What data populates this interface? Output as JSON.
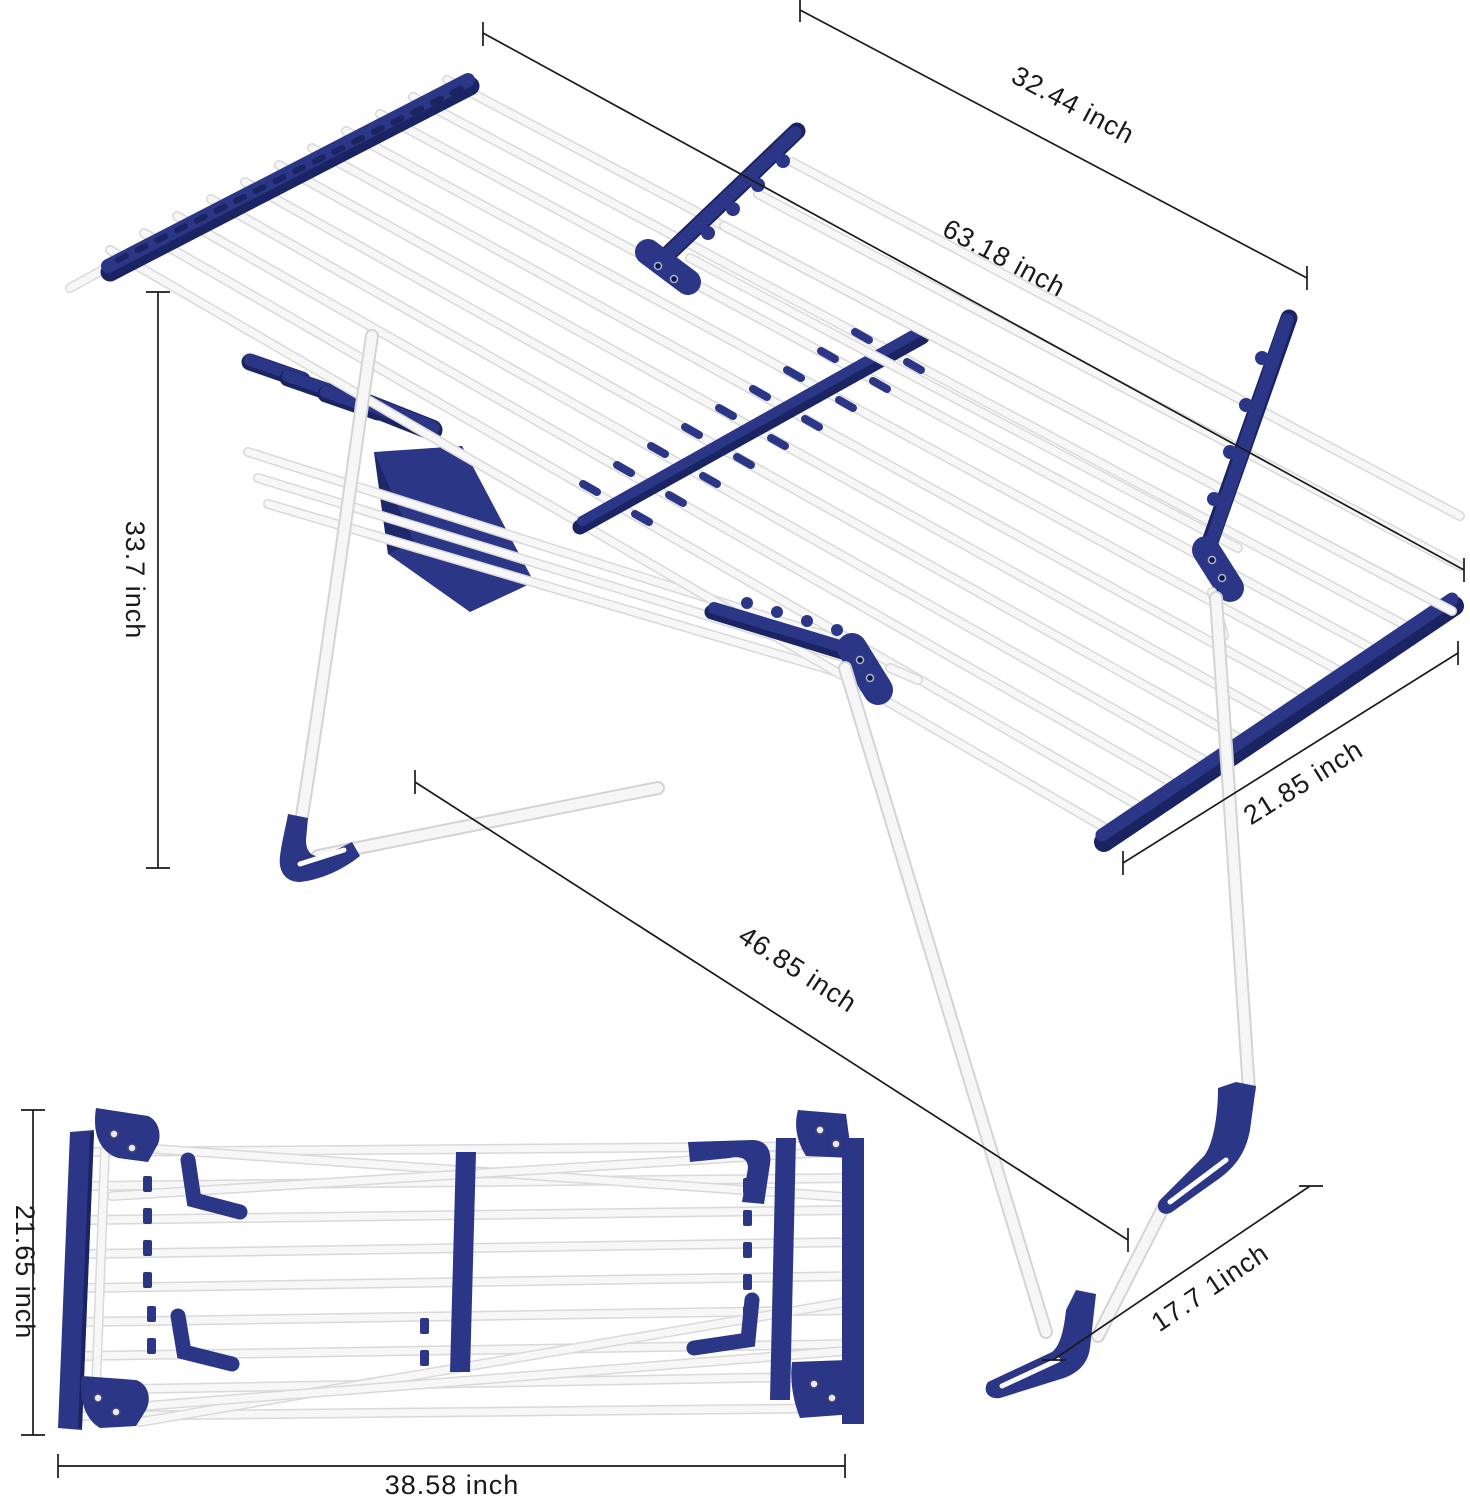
{
  "unit": "inch",
  "colors": {
    "navy": "#2b3687",
    "navy_dark": "#1b2462",
    "rod_white": "#f7f7f7",
    "rod_edge": "#d9d9d9",
    "dimension_line": "#1a1a1a",
    "background": "#ffffff"
  },
  "dimensions": [
    {
      "id": "wing-width",
      "label": "32.44 inch"
    },
    {
      "id": "total-length",
      "label": "63.18 inch"
    },
    {
      "id": "stand-height",
      "label": "33.7 inch"
    },
    {
      "id": "deck-depth",
      "label": "21.85 inch"
    },
    {
      "id": "base-length",
      "label": "46.85 inch"
    },
    {
      "id": "base-depth",
      "label": "17.7 1inch"
    },
    {
      "id": "folded-width",
      "label": "21.65 inch"
    },
    {
      "id": "folded-length",
      "label": "38.58 inch"
    }
  ]
}
